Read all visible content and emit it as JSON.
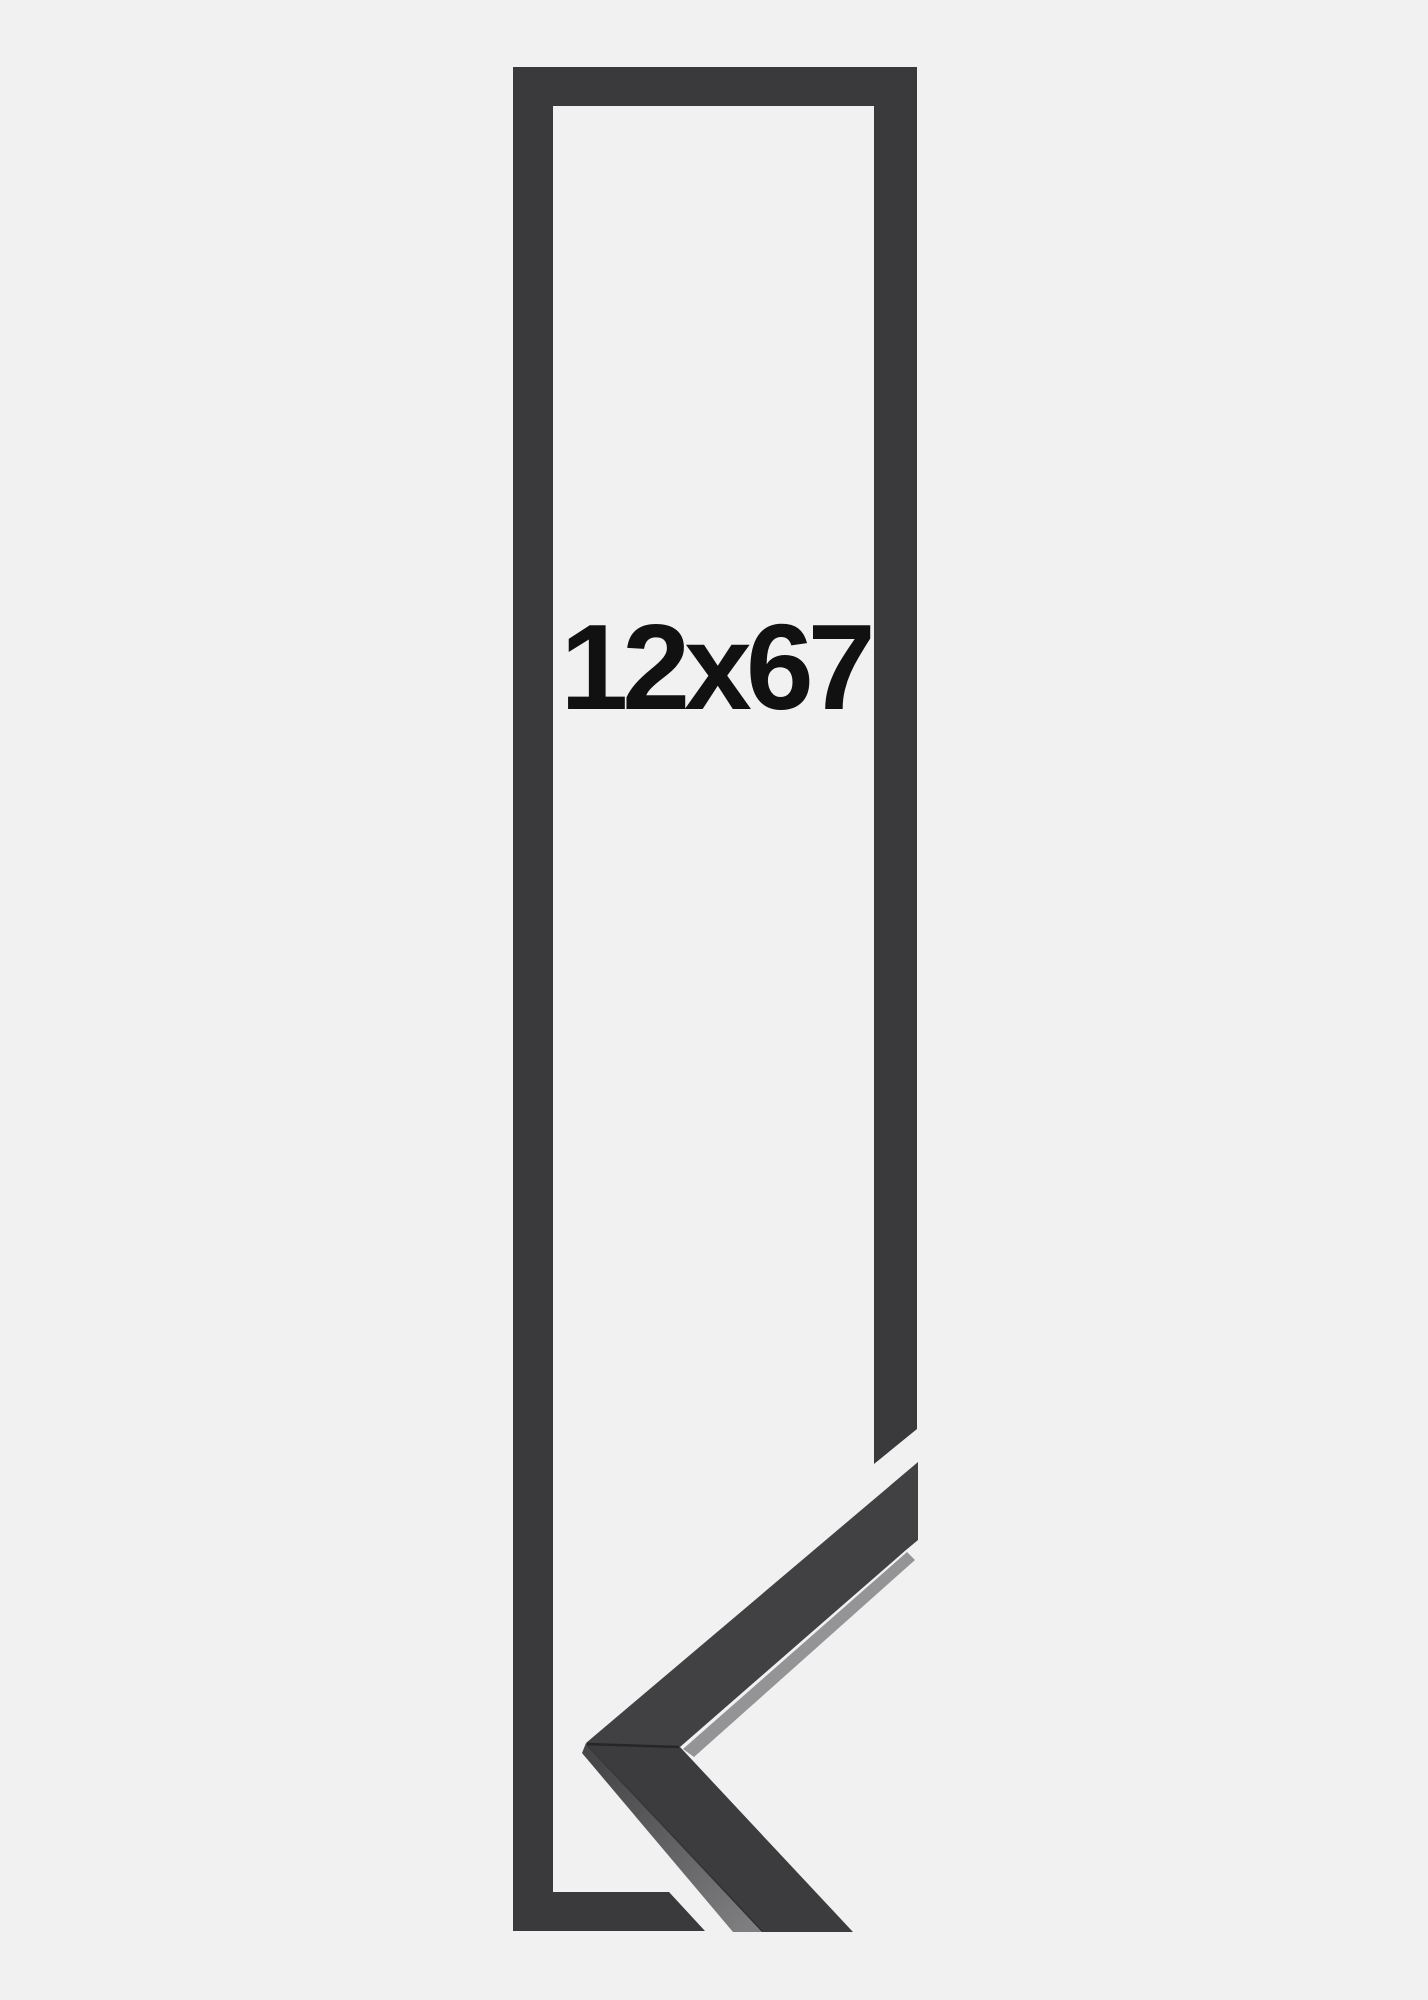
{
  "product": {
    "size_label": "12x67"
  },
  "colors": {
    "background": "#f1f1f2",
    "frame": "#3a3a3c",
    "arm_upper": "#414144",
    "arm_lower": "#3c3c3e",
    "frame_edge": "#26262a",
    "side_face_dark": "#47474a",
    "side_face_light": "#7e7e80",
    "edge_strip": "#8a8a8c",
    "text": "#111111"
  }
}
